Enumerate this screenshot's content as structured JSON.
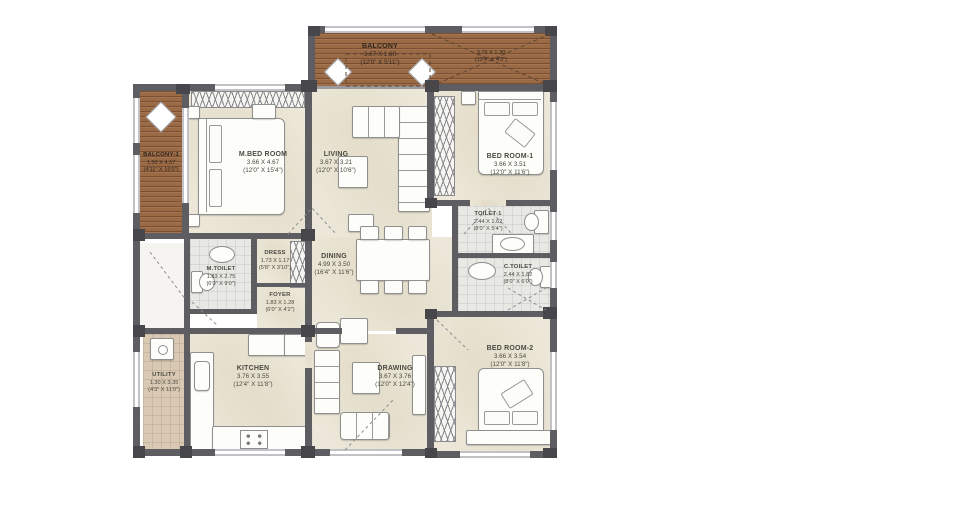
{
  "plan": {
    "type": "residential-floor-plan",
    "background": "#ffffff",
    "colors": {
      "wall": "#5d5d62",
      "wood_deck": "#9a6a45",
      "floor": "#ece7d8",
      "toilet_tile": "#e8e8e4",
      "utility_tile": "#d9c9b2",
      "label_text": "#4b4b42"
    }
  },
  "rooms": [
    {
      "id": "balcony-top",
      "name": "BALCONY",
      "metric": "3.67 X 1.80",
      "imperial": "(12'0\" X 5'11\")"
    },
    {
      "id": "balcony-top-right",
      "name": "",
      "metric": "3.76 X 1.30",
      "imperial": "(12'4\" X 4'3\")"
    },
    {
      "id": "balcony-1",
      "name": "BALCONY-1",
      "metric": "1.50 X 4.57",
      "imperial": "(4'11\" X 15'0\")"
    },
    {
      "id": "m-bed-room",
      "name": "M.BED ROOM",
      "metric": "3.66 X 4.67",
      "imperial": "(12'0\" X 15'4\")"
    },
    {
      "id": "living",
      "name": "LIVING",
      "metric": "3.67 X 3.21",
      "imperial": "(12'0\" X 10'6\")"
    },
    {
      "id": "bed-room-1",
      "name": "BED ROOM-1",
      "metric": "3.66 X 3.51",
      "imperial": "(12'0\" X 11'6\")"
    },
    {
      "id": "toilet-1",
      "name": "TOILET-1",
      "metric": "2.44 X 1.62",
      "imperial": "(8'0\" X 5'4\")"
    },
    {
      "id": "c-toilet",
      "name": "C.TOILET",
      "metric": "2.44 X 1.82",
      "imperial": "(8'0\" X 6'0\")"
    },
    {
      "id": "dining",
      "name": "DINING",
      "metric": "4.99 X 3.50",
      "imperial": "(16'4\" X 11'6\")"
    },
    {
      "id": "dress",
      "name": "DRESS",
      "metric": "1.73 X 1.17",
      "imperial": "(5'8\" X 3'10\")"
    },
    {
      "id": "m-toilet",
      "name": "M.TOILET",
      "metric": "1.83 X 2.75",
      "imperial": "(6'0\" X 9'0\")"
    },
    {
      "id": "foyer",
      "name": "FOYER",
      "metric": "1.83 X 1.28",
      "imperial": "(6'0\" X 4'2\")"
    },
    {
      "id": "utility",
      "name": "UTILITY",
      "metric": "1.30 X 3.35",
      "imperial": "(4'3\" X 11'0\")"
    },
    {
      "id": "kitchen",
      "name": "KITCHEN",
      "metric": "3.76 X 3.55",
      "imperial": "(12'4\" X 11'8\")"
    },
    {
      "id": "drawing",
      "name": "DRAWING",
      "metric": "3.67 X 3.76",
      "imperial": "(12'0\" X 12'4\")"
    },
    {
      "id": "bed-room-2",
      "name": "BED ROOM-2",
      "metric": "3.66 X 3.54",
      "imperial": "(12'0\" X 11'8\")"
    }
  ]
}
